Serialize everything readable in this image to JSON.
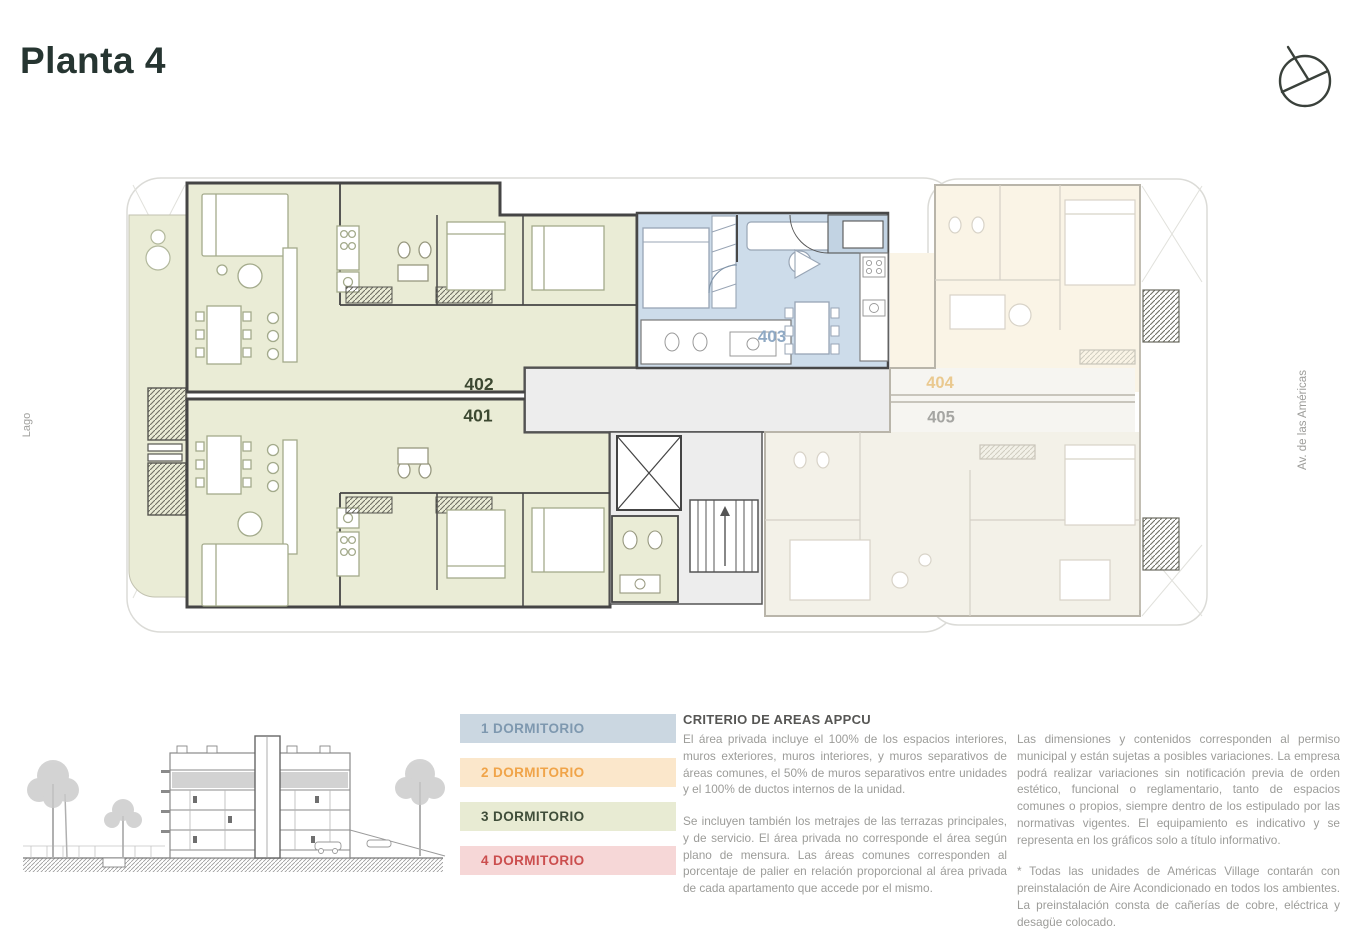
{
  "header": {
    "title": "Planta 4"
  },
  "colors": {
    "unit_3dorm_fill": "#eaecd6",
    "unit_1dorm_fill": "#cddcea",
    "corridor_fill": "#ededed",
    "unit_404_faded_fill": "#faf4e6",
    "unit_405_faded_fill": "#f3f1e8",
    "label_401_402": "#3c4831",
    "label_403": "#8fa9c4",
    "label_404": "#eac98f",
    "label_405": "#a5a5a2"
  },
  "plan": {
    "unit_labels": {
      "u401": "401",
      "u402": "402",
      "u403": "403",
      "u404": "404",
      "u405": "405"
    },
    "context_labels": {
      "left": "Lago",
      "right": "Av. de las Américas"
    }
  },
  "legend": {
    "items": [
      {
        "label": "1 DORMITORIO",
        "bg": "#cbd7e1",
        "fg": "#7e98af"
      },
      {
        "label": "2 DORMITORIO",
        "bg": "#fbe7cb",
        "fg": "#f0a449"
      },
      {
        "label": "3 DORMITORIO",
        "bg": "#e8ebd3",
        "fg": "#3f4d39"
      },
      {
        "label": "4 DORMITORIO",
        "bg": "#f6d7d7",
        "fg": "#cb4e4e"
      }
    ]
  },
  "notes": {
    "criteria": {
      "title": "CRITERIO DE AREAS APPCU",
      "p1": "El área privada incluye el 100% de los espacios interiores, muros exteriores, muros interiores, y muros separativos de áreas comunes, el 50% de muros separativos entre unidades y el 100% de ductos internos de la unidad.",
      "p2": "Se incluyen también los metrajes de las terrazas principales, y de servicio. El área privada no corresponde el área según plano de mensura. Las áreas comunes corresponden al porcentaje de palier en relación proporcional al área privada de cada apartamento que accede por el mismo."
    },
    "disclaimer": {
      "p1": "Las dimensiones y contenidos corresponden al permiso municipal y están sujetas a posibles variaciones. La empresa podrá realizar variaciones sin notificación previa de orden estético, funcional o reglamentario, tanto de espacios comunes o propios, siempre dentro de los estipulado por las normativas vigentes. El equipamiento es indicativo y se representa en los gráficos solo a título informativo.",
      "p2": "* Todas las unidades de Américas Village contarán con preinstalación de Aire Acondicionado en todos los ambientes. La preinstalación consta de cañerías de cobre, eléctrica y desagüe colocado."
    }
  },
  "icons": {
    "north_arrow": "north-arrow-icon"
  }
}
